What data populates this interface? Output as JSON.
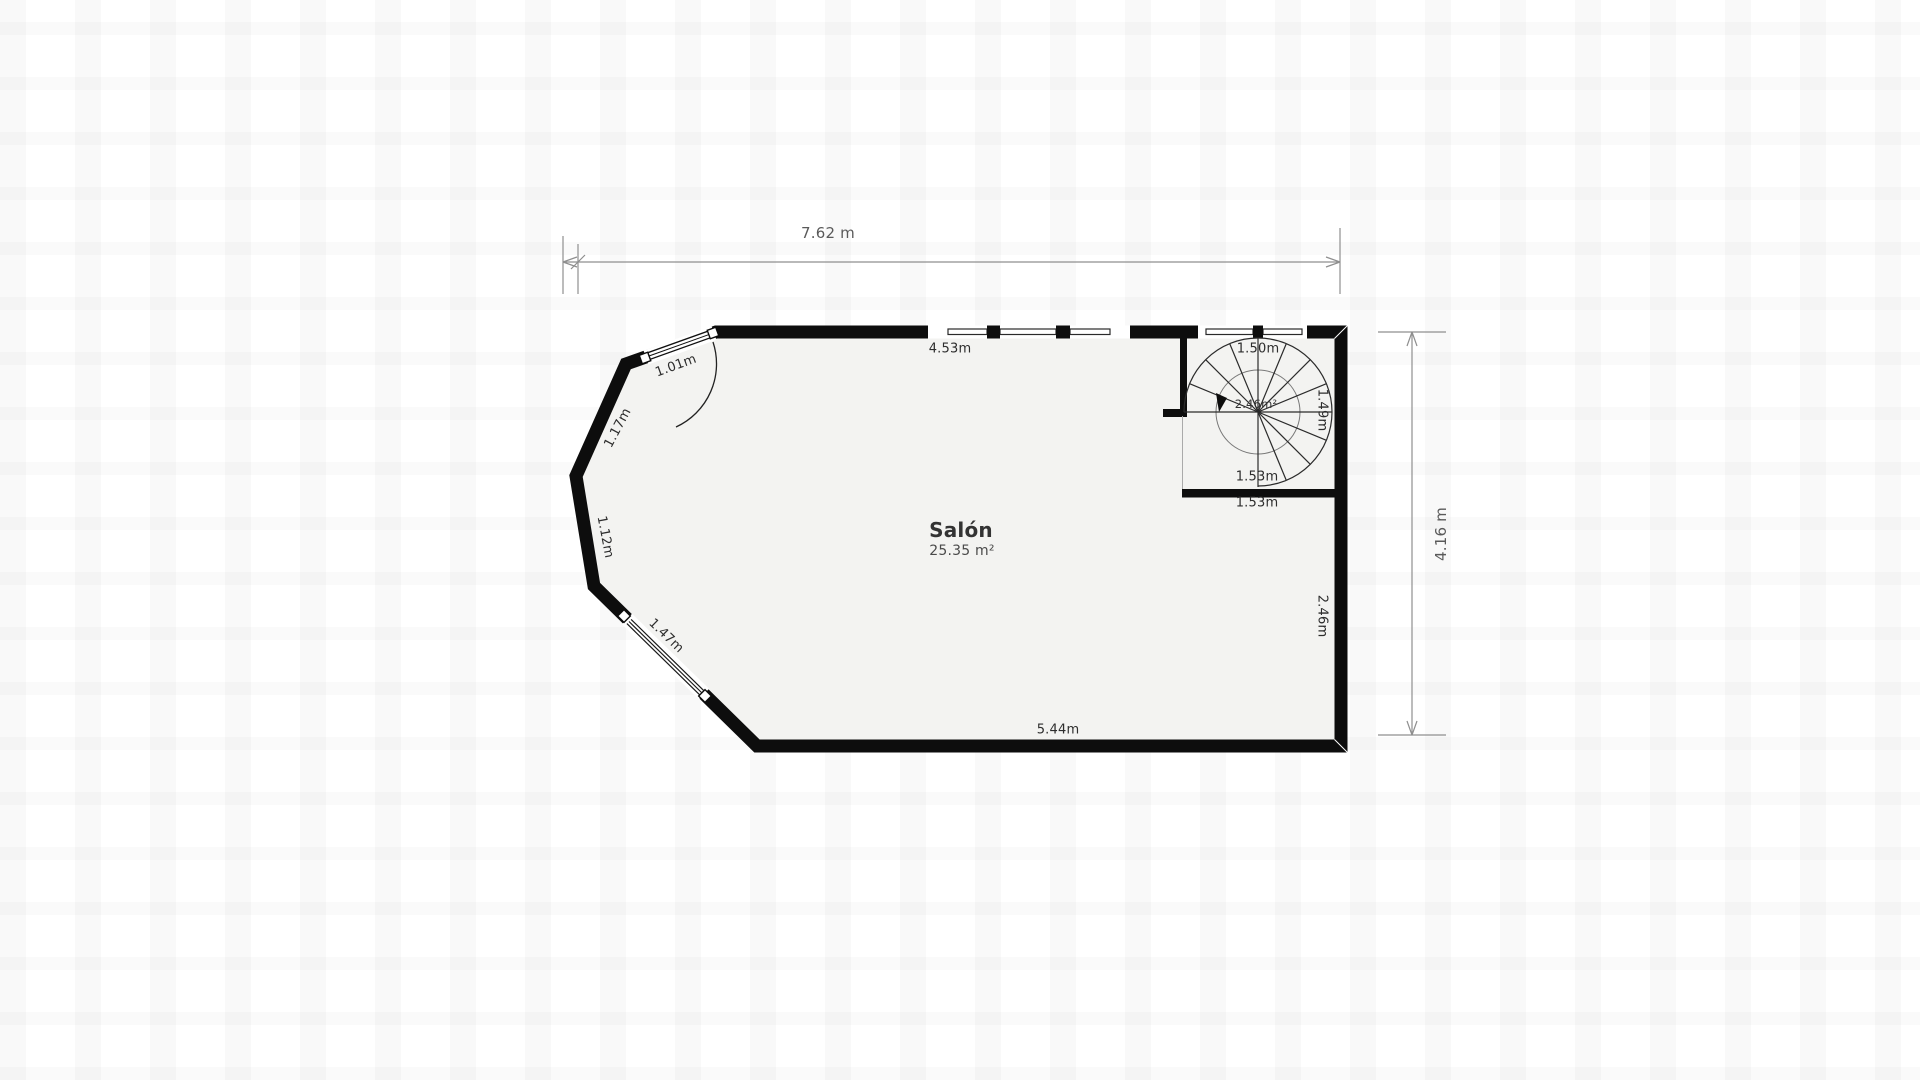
{
  "plan": {
    "room": {
      "name": "Salón",
      "area": "25.35 m²"
    },
    "overall_dimensions": {
      "width": "7.62 m",
      "height": "4.16 m"
    },
    "wall_labels": {
      "top_window_wall": "4.53m",
      "bottom_wall": "5.44m",
      "right_lower_wall": "2.46m",
      "left_upper_diagonal_wall": "1.17m",
      "left_middle_wall": "1.12m",
      "left_lower_window_wall": "1.47m",
      "entry_door": "1.01m"
    },
    "staircase": {
      "type": "spiral-staircase",
      "top_window": "1.50m",
      "right_side": "1.49m",
      "inner_width": "1.53m",
      "outer_width": "1.53m",
      "area": "2.46m²"
    },
    "colors": {
      "wall": "#0d0d0d",
      "room_fill": "#f3f3f1",
      "dimension_line": "#8f8f8f",
      "label_text": "#2d2d2d"
    }
  }
}
